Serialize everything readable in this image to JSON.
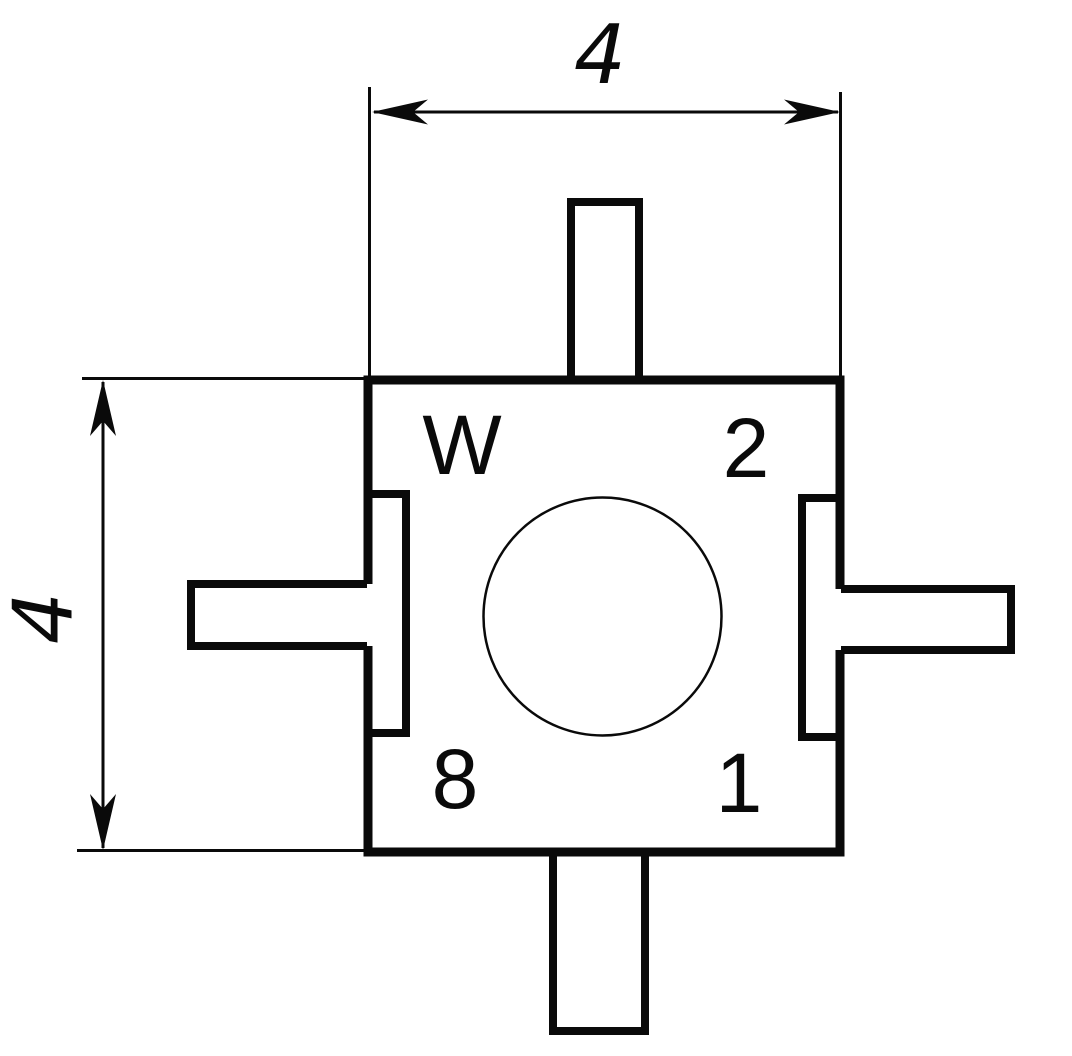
{
  "drawing": {
    "corner_labels": {
      "top_left": "W",
      "top_right": "2",
      "bottom_left": "8",
      "bottom_right": "1"
    },
    "dimensions": {
      "width_label": "4",
      "height_label": "4"
    },
    "colors": {
      "ink": "#0a0a0a",
      "paper": "#ffffff"
    }
  }
}
